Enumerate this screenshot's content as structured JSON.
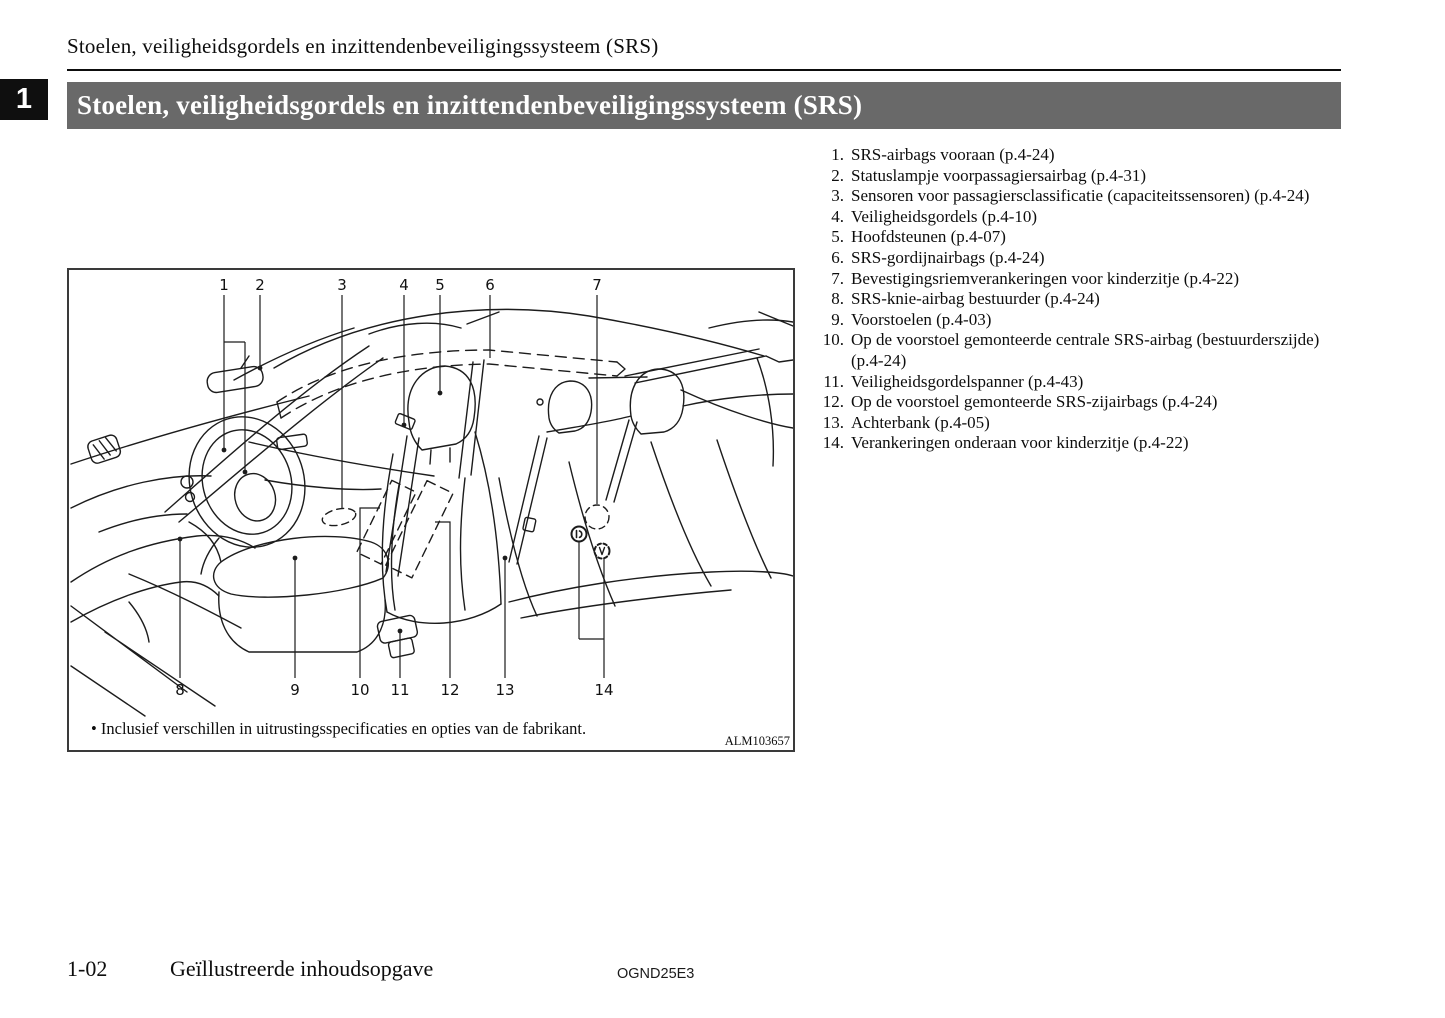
{
  "header": {
    "running_title": "Stoelen, veiligheidsgordels en inzittendenbeveiligingssysteem (SRS)",
    "chapter_number": "1",
    "section_title": "Stoelen, veiligheidsgordels en inzittendenbeveiligingssysteem (SRS)"
  },
  "legend": {
    "items": [
      {
        "num": "1.",
        "text": "SRS-airbags vooraan (p.4-24)"
      },
      {
        "num": "2.",
        "text": "Statuslampje voorpassagiersairbag (p.4-31)"
      },
      {
        "num": "3.",
        "text": "Sensoren voor passagiersclassificatie (capaciteitssensoren) (p.4-24)"
      },
      {
        "num": "4.",
        "text": "Veiligheidsgordels (p.4-10)"
      },
      {
        "num": "5.",
        "text": "Hoofdsteunen (p.4-07)"
      },
      {
        "num": "6.",
        "text": "SRS-gordijnairbags (p.4-24)"
      },
      {
        "num": "7.",
        "text": "Bevestigingsriemverankeringen voor kinderzitje (p.4-22)"
      },
      {
        "num": "8.",
        "text": "SRS-knie-airbag bestuurder (p.4-24)"
      },
      {
        "num": "9.",
        "text": "Voorstoelen (p.4-03)"
      },
      {
        "num": "10.",
        "text": "Op de voorstoel gemonteerde centrale SRS-airbag (bestuurderszij­de) (p.4-24)"
      },
      {
        "num": "11.",
        "text": "Veiligheidsgordelspanner (p.4-43)"
      },
      {
        "num": "12.",
        "text": "Op de voorstoel gemonteerde SRS-zijairbags (p.4-24)"
      },
      {
        "num": "13.",
        "text": "Achterbank (p.4-05)"
      },
      {
        "num": "14.",
        "text": "Verankeringen onderaan voor kinderzitje (p.4-22)"
      }
    ]
  },
  "figure": {
    "callouts_top": [
      "1",
      "2",
      "3",
      "4",
      "5",
      "6",
      "7"
    ],
    "callouts_bottom": [
      "8",
      "9",
      "10",
      "11",
      "12",
      "13",
      "14"
    ],
    "footnote": "• Inclusief verschillen in uitrustingsspecificaties en opties van de fabrikant.",
    "figure_code": "ALM103657"
  },
  "footer": {
    "page_number": "1-02",
    "section_name": "Geïllustreerde inhoudsopgave",
    "doc_code": "OGND25E3"
  },
  "colors": {
    "section_bar_bg": "#696969",
    "chapter_tab_bg": "#0f0f0f",
    "line_art": "#1c1c1c"
  }
}
